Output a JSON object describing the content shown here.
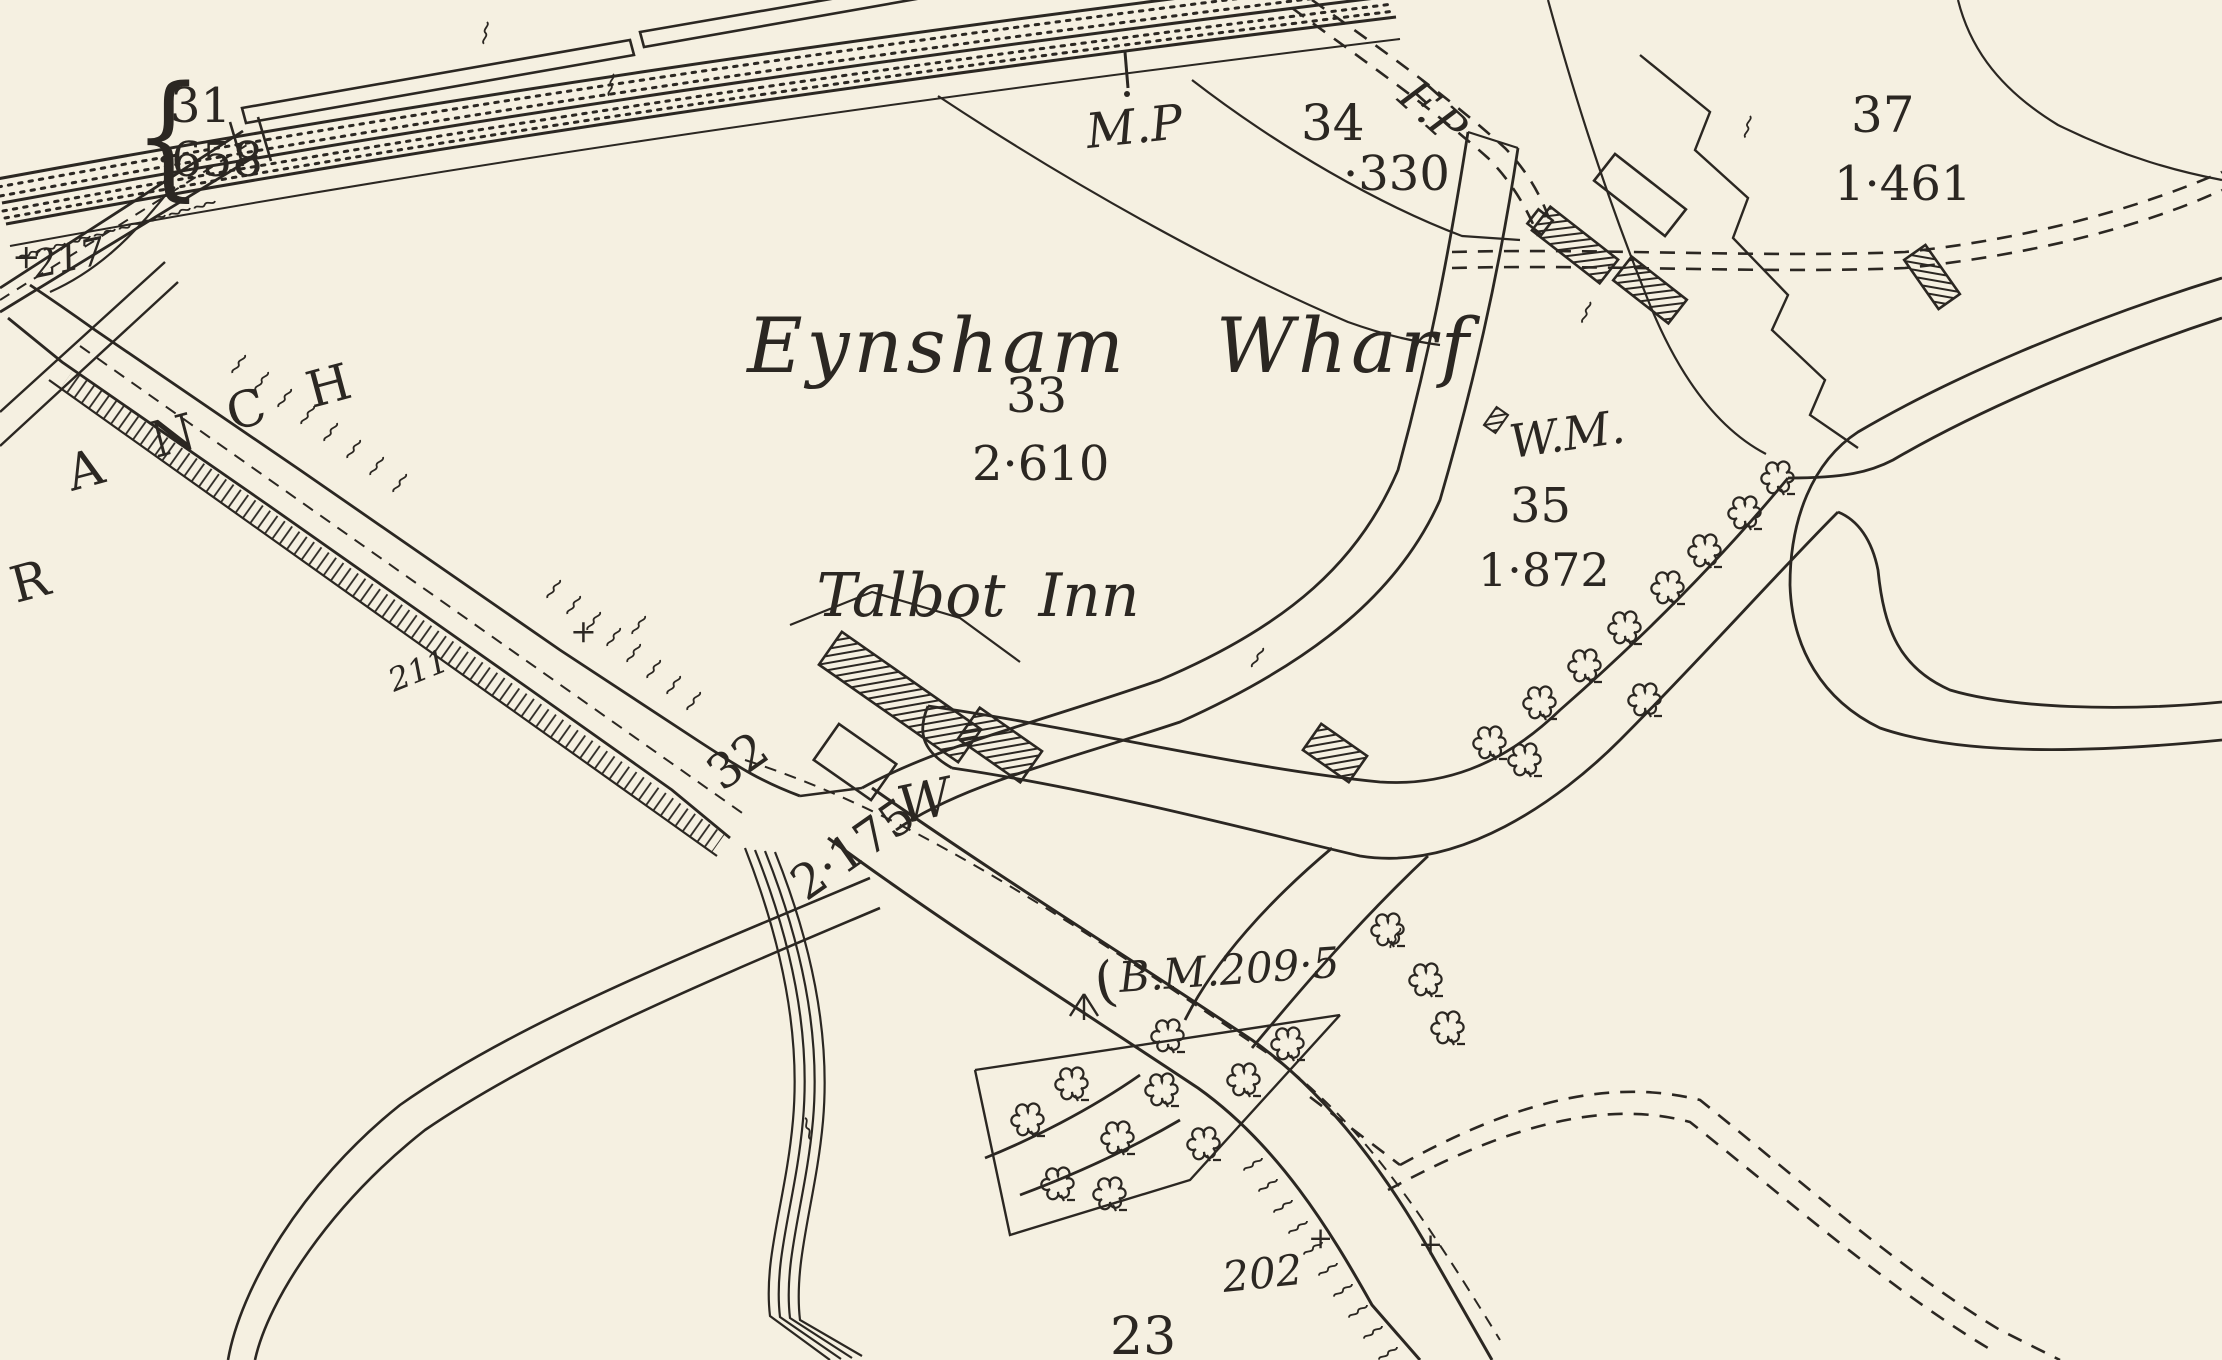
{
  "map": {
    "names": {
      "wharf": "Eynsham Wharf",
      "inn": "Talbot Inn"
    },
    "branch_letters": [
      "R",
      "A",
      "N",
      "C",
      "H"
    ],
    "parcels": {
      "p31": {
        "number": "31",
        "area": "·658"
      },
      "p33": {
        "number": "33",
        "area": "2·610"
      },
      "p34": {
        "number": "34",
        "area": "·330"
      },
      "p35": {
        "number": "35",
        "area": "1·872"
      },
      "p37": {
        "number": "37",
        "area": "1·461"
      },
      "p32": {
        "number": "32",
        "area": "2·175"
      },
      "p23": {
        "number": "23"
      }
    },
    "spot_heights": {
      "s217": "217",
      "s211": "211",
      "s202": "202"
    },
    "annotations": {
      "milepost": "M.P",
      "footpath": "F.P",
      "water_meter": "W.M.",
      "well": "W",
      "benchmark": "B.M.209·5",
      "brace": "{",
      "paren": "(",
      "plus": "+"
    },
    "colors": {
      "ink": "#2b2722",
      "paper": "#f5f0e1"
    }
  }
}
